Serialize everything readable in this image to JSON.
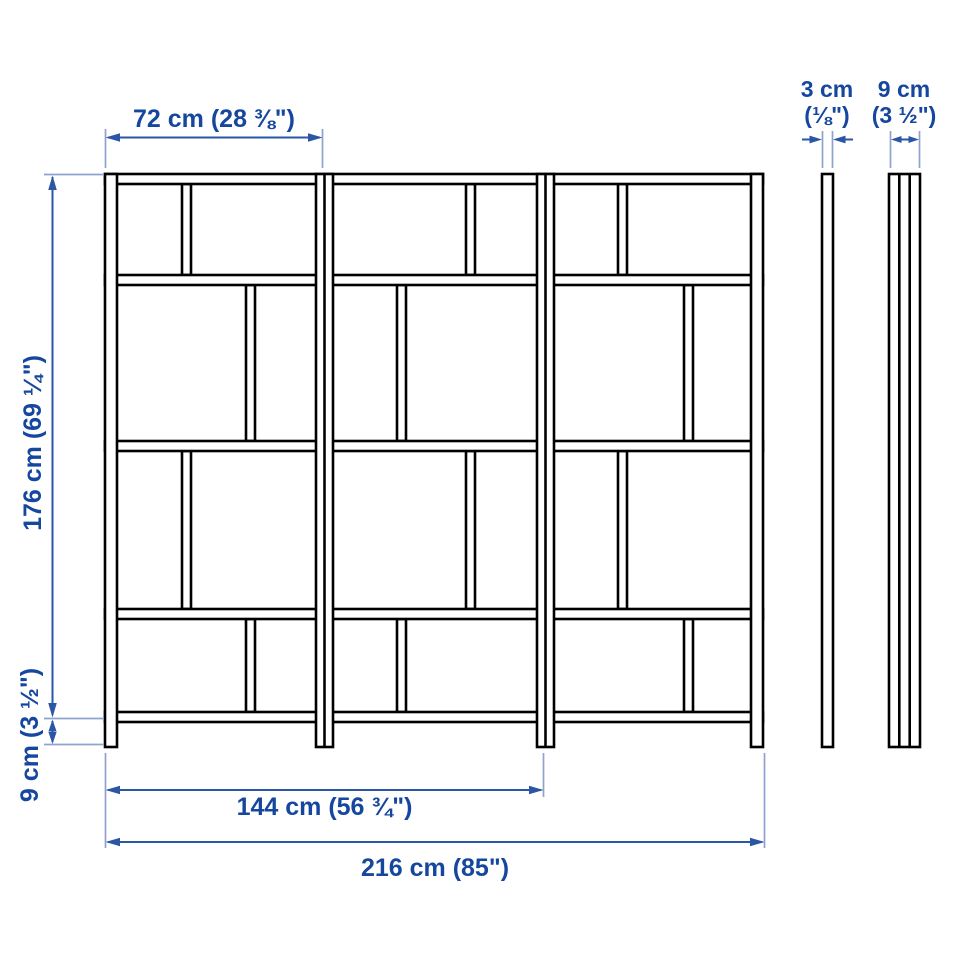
{
  "diagram": {
    "type": "product-dimension-drawing",
    "views": {
      "front": "three-section shelving unit front elevation",
      "side_thin": "side profile (frame only)",
      "side_deep": "side profile (with shelf depth)"
    },
    "labels": {
      "bay_width": "72 cm (28 ⅜\")",
      "height": "176 cm (69 ¼\")",
      "floor_clearance": "9 cm (3 ½\")",
      "double_bay_width": "144 cm (56 ¾\")",
      "total_width": "216 cm (85\")",
      "thin_depth_cm": "3 cm",
      "thin_depth_in": "(⅛\")",
      "deep_depth_cm": "9 cm",
      "deep_depth_in": "(3 ½\")"
    },
    "measurements": [
      {
        "dimension": "section width",
        "label": "72 cm (28 ⅜\")"
      },
      {
        "dimension": "height",
        "label": "176 cm (69 ¼\")"
      },
      {
        "dimension": "floor to bottom shelf",
        "label": "9 cm (3 ½\")"
      },
      {
        "dimension": "two-section width",
        "label": "144 cm (56 ¾\")"
      },
      {
        "dimension": "total width",
        "label": "216 cm (85\")"
      },
      {
        "dimension": "frame thickness",
        "label": "3 cm (⅛\")"
      },
      {
        "dimension": "depth",
        "label": "9 cm (3 ½\")"
      }
    ],
    "colors": {
      "outline": "#000000",
      "dimension_text": "#16479e",
      "dimension_line": "#2b55a5",
      "extension_line": "#8fa3cf",
      "background": "#ffffff"
    }
  }
}
